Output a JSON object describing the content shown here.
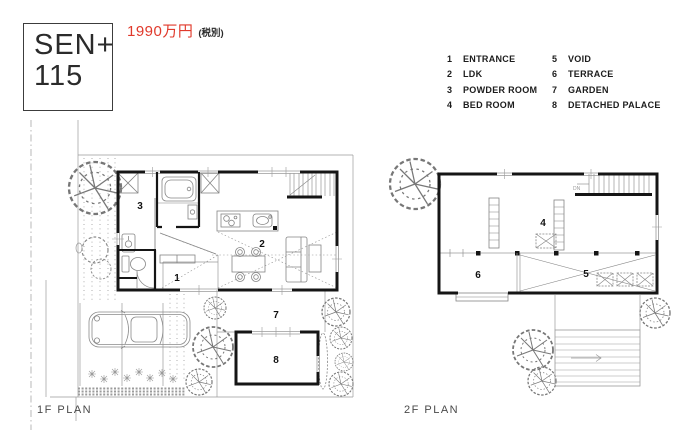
{
  "logo": {
    "line1": "SEN+",
    "line2": "115"
  },
  "price": {
    "amount": "1990万円",
    "tax_note": "(税別)"
  },
  "legend": {
    "col1": [
      {
        "num": "1",
        "label": "ENTRANCE"
      },
      {
        "num": "2",
        "label": "LDK"
      },
      {
        "num": "3",
        "label": "POWDER ROOM"
      },
      {
        "num": "4",
        "label": "BED ROOM"
      }
    ],
    "col2": [
      {
        "num": "5",
        "label": "VOID"
      },
      {
        "num": "6",
        "label": "TERRACE"
      },
      {
        "num": "7",
        "label": "GARDEN"
      },
      {
        "num": "8",
        "label": "DETACHED PALACE"
      }
    ]
  },
  "plans": {
    "floor1": {
      "label": "1F PLAN",
      "room1": "1",
      "room2": "2",
      "room3": "3",
      "room7": "7",
      "room8": "8"
    },
    "floor2": {
      "label": "2F PLAN",
      "room4": "4",
      "room5": "5",
      "room6": "6",
      "stairs_label": "DN"
    }
  },
  "colors": {
    "price_red": "#e0392b",
    "wall_black": "#151515",
    "line_gray": "#8a8a8a"
  }
}
